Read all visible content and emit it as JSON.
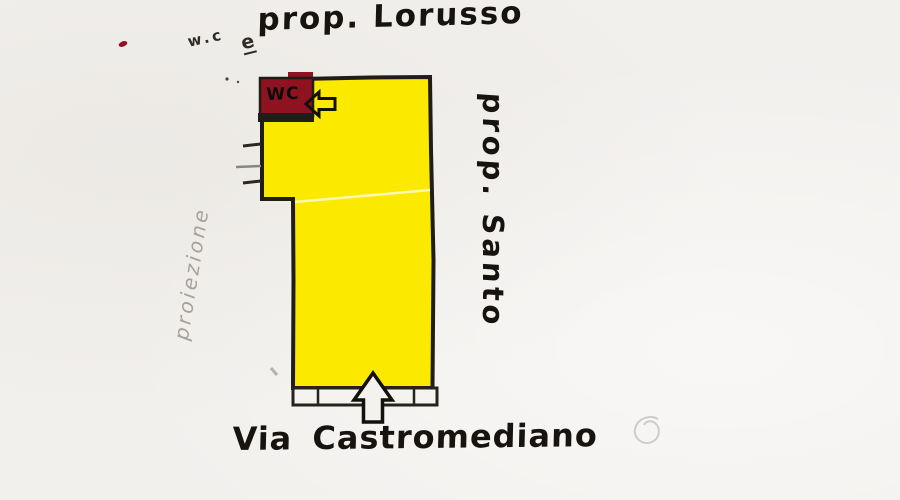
{
  "labels": {
    "top_neighbor": "prop. Lorusso",
    "right_neighbor": "prop. Santo",
    "street": "Via Castromediano",
    "wc_room": "WC",
    "wc_note": "w.c",
    "wc_note_flourish": "e",
    "left_margin_note": "proiezione"
  },
  "icons": {
    "left_arrow": "left-arrow-icon",
    "up_arrow": "up-arrow-icon"
  },
  "colors": {
    "paper": "#f2f0ed",
    "plan_fill": "#fbea00",
    "wc_fill": "#8e1220",
    "ink": "#1e1b17",
    "pencil": "#aaa69f",
    "red_ink_dot": "#8e1220",
    "sidewalk_fill": "#f5f3f0"
  }
}
